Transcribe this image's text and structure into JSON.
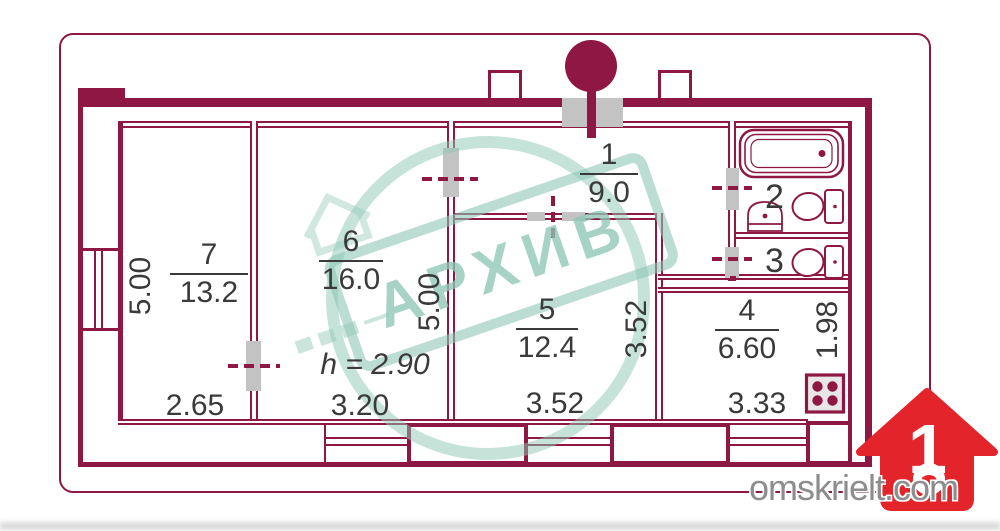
{
  "rooms": {
    "r1": {
      "number": "1",
      "area": "9.0"
    },
    "r2": {
      "number": "2"
    },
    "r3": {
      "number": "3"
    },
    "r4": {
      "number": "4",
      "area": "6.60"
    },
    "r5": {
      "number": "5",
      "area": "12.4"
    },
    "r6": {
      "number": "6",
      "area": "16.0"
    },
    "r7": {
      "number": "7",
      "area": "13.2"
    }
  },
  "dims": {
    "room7_width": "2.65",
    "room6_width": "3.20",
    "room5_width": "3.52",
    "kitchen_width": "3.33",
    "room7_depth": "5.00",
    "room5_depth": "5.00",
    "room5_right_depth": "3.52",
    "kitchen_depth": "1.98",
    "ceiling_height": "h = 2.90"
  },
  "watermark": {
    "stamp_text": "АРХИВ"
  },
  "branding": {
    "site": "omskrielt.com",
    "logo_number": "1"
  },
  "colors": {
    "wall": "#8e1843",
    "jamb": "#c3c3c3",
    "ink": "#3a3a3a",
    "stamp": "#8ec7b6",
    "logo": "#e3242b",
    "site": "#8d8d8d"
  }
}
